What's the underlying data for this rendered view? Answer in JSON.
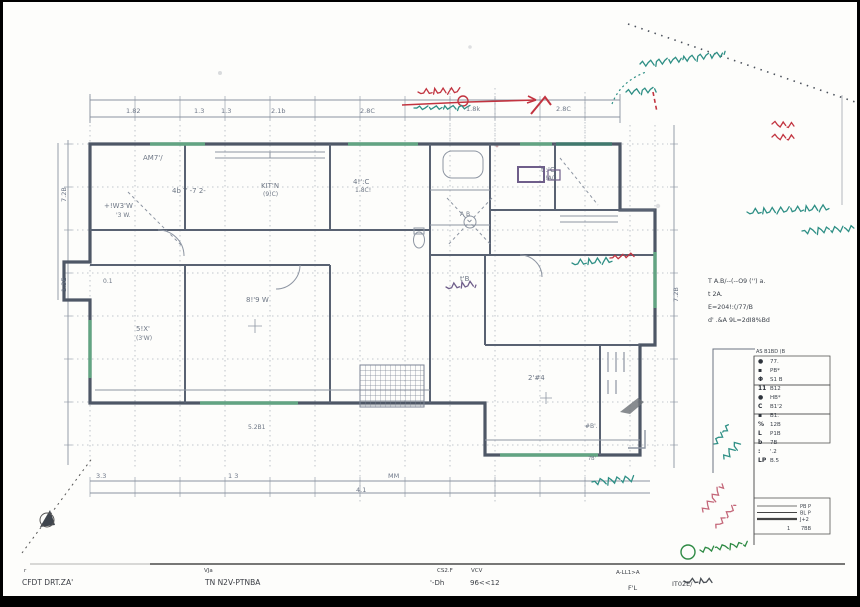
{
  "colors": {
    "plan_ink": "#5c6575",
    "wall": "#4e5766",
    "grid": "#adb4bd",
    "dim": "#8a93a0",
    "teal": "#2e8f85",
    "red": "#c23440",
    "green": "#2e8a44",
    "pink": "#c4687a",
    "purple": "#6f5e8a",
    "gray_note": "#4a4f55",
    "window_green": "#66b287",
    "window_teal": "#3f7d6e"
  },
  "dimensions": {
    "top": [
      {
        "t": "1.82",
        "x": 126,
        "y": 113
      },
      {
        "t": "1.3",
        "x": 194,
        "y": 113
      },
      {
        "t": "1.3",
        "x": 221,
        "y": 113
      },
      {
        "t": "2.1b",
        "x": 271,
        "y": 113
      },
      {
        "t": "2.8C",
        "x": 360,
        "y": 113
      },
      {
        "t": "1.8k",
        "x": 466,
        "y": 111
      },
      {
        "t": "2.8C",
        "x": 556,
        "y": 111
      }
    ],
    "bottom": [
      {
        "t": "3.3",
        "x": 96,
        "y": 478
      },
      {
        "t": "1 3",
        "x": 228,
        "y": 478
      },
      {
        "t": "MM",
        "x": 388,
        "y": 478
      },
      {
        "t": "4.1",
        "x": 356,
        "y": 492
      }
    ],
    "left": [
      {
        "t": "7.2B",
        "x": 66,
        "y": 202
      },
      {
        "t": "1.3E",
        "x": 66,
        "y": 292
      }
    ],
    "right": [
      {
        "t": "7.2B",
        "x": 678,
        "y": 302
      }
    ]
  },
  "room_labels": [
    {
      "t": "AM7'/",
      "x": 143,
      "y": 160,
      "s": 7
    },
    {
      "t": "4b Y -7 2-",
      "x": 172,
      "y": 193,
      "s": 7
    },
    {
      "t": "+!W3'W",
      "x": 104,
      "y": 208,
      "s": 7
    },
    {
      "t": "'3 W.",
      "x": 116,
      "y": 217,
      "s": 6
    },
    {
      "t": "KIT'N",
      "x": 261,
      "y": 188,
      "s": 7
    },
    {
      "t": "(9!C)",
      "x": 263,
      "y": 196,
      "s": 6
    },
    {
      "t": "4!':C",
      "x": 353,
      "y": 184,
      "s": 7
    },
    {
      "t": "1.8C!",
      "x": 355,
      "y": 192,
      "s": 6
    },
    {
      "t": "t':'C",
      "x": 541,
      "y": 172,
      "s": 7
    },
    {
      "t": "!!A()",
      "x": 543,
      "y": 180,
      "s": 6
    },
    {
      "t": "A B",
      "x": 460,
      "y": 216,
      "s": 6
    },
    {
      "t": "8!'9 W",
      "x": 246,
      "y": 302,
      "s": 7
    },
    {
      "t": "5!X'",
      "x": 136,
      "y": 331,
      "s": 7
    },
    {
      "t": "(3'W)",
      "x": 136,
      "y": 340,
      "s": 6
    },
    {
      "t": "t'B",
      "x": 460,
      "y": 281,
      "s": 7
    },
    {
      "t": "0.1",
      "x": 103,
      "y": 283,
      "s": 6
    },
    {
      "t": "2'#4",
      "x": 528,
      "y": 380,
      "s": 7
    },
    {
      "t": "5.2B1",
      "x": 248,
      "y": 429,
      "s": 6
    },
    {
      "t": "#B'.",
      "x": 585,
      "y": 428,
      "s": 6
    },
    {
      "t": "7B'",
      "x": 588,
      "y": 460,
      "s": 5
    }
  ],
  "legend": {
    "header": "AS B1BD (B",
    "rows": [
      {
        "sym": "●",
        "label": "77."
      },
      {
        "sym": "▪",
        "label": "PB*"
      },
      {
        "sym": "Φ",
        "label": "S1 B"
      },
      {
        "sym": "11",
        "label": "B12"
      },
      {
        "sym": "●",
        "label": "HB*"
      },
      {
        "sym": "C",
        "label": "B1'2"
      },
      {
        "sym": "▪",
        "label": "B1."
      },
      {
        "sym": "%",
        "label": "12B"
      },
      {
        "sym": "L",
        "label": "P1B"
      },
      {
        "sym": "b",
        "label": "7B"
      },
      {
        "sym": ":",
        "label": "'.2"
      },
      {
        "sym": "LP",
        "label": "B.5"
      }
    ],
    "line_rows": [
      {
        "label": "PB P",
        "weight": 0.8
      },
      {
        "label": "BL P",
        "weight": 1.1
      },
      {
        "label": "J+2",
        "weight": 2.2
      }
    ],
    "scale_left": "1",
    "scale_right": "7BB"
  },
  "notes": {
    "lines": [
      "T A.B/--(--O9 ('') a.",
      "t  2A.",
      "E=204!:(/77/B",
      "d' .&A 9L=2dI8%Bd"
    ]
  },
  "title_block": {
    "fields": [
      {
        "label": "r",
        "value": "CFDT DRT.ZA'"
      },
      {
        "label": "VJa",
        "value": "TN N2V-PTNBA"
      },
      {
        "label": "CS2.F",
        "value": "'-Dh"
      },
      {
        "label": "VCV",
        "value": "96<<12"
      },
      {
        "label": "A-LL1>A",
        "value": "F'L"
      },
      {
        "label": "",
        "value": "IT02E/"
      }
    ]
  },
  "annotations": {
    "scribbles": [
      {
        "id": "teal-boundary-note-1",
        "color": "teal",
        "x": 640,
        "y": 64,
        "w": 86,
        "amp": 2.6,
        "rot": -7
      },
      {
        "id": "teal-boundary-note-2",
        "color": "teal",
        "x": 626,
        "y": 92,
        "w": 30,
        "amp": 2.4,
        "rot": -5
      },
      {
        "id": "teal-under-redline",
        "color": "teal",
        "x": 414,
        "y": 108,
        "w": 56,
        "amp": 2.8,
        "rot": -1
      },
      {
        "id": "teal-note-right-1",
        "color": "teal",
        "x": 747,
        "y": 212,
        "w": 82,
        "amp": 2.6,
        "rot": -3
      },
      {
        "id": "teal-note-right-2",
        "color": "teal",
        "x": 802,
        "y": 231,
        "w": 52,
        "amp": 2.4,
        "rot": -3
      },
      {
        "id": "teal-note-plan",
        "color": "teal",
        "x": 572,
        "y": 263,
        "w": 40,
        "amp": 2.6,
        "rot": -4
      },
      {
        "id": "teal-note-legend-1",
        "color": "teal",
        "x": 714,
        "y": 444,
        "w": 24,
        "amp": 3,
        "rot": -52
      },
      {
        "id": "teal-note-legend-2",
        "color": "teal",
        "x": 724,
        "y": 459,
        "w": 22,
        "amp": 3,
        "rot": -50
      },
      {
        "id": "teal-note-bottom",
        "color": "teal",
        "x": 592,
        "y": 482,
        "w": 42,
        "amp": 2.6,
        "rot": -5
      },
      {
        "id": "red-note-topline",
        "color": "red",
        "x": 418,
        "y": 92,
        "w": 42,
        "amp": 2.4,
        "rot": -2
      },
      {
        "id": "red-mark-room",
        "color": "red",
        "x": 610,
        "y": 258,
        "w": 24,
        "amp": 3,
        "rot": -8
      },
      {
        "id": "red-seal-1",
        "color": "red",
        "x": 772,
        "y": 124,
        "w": 22,
        "amp": 3.4,
        "rot": 4
      },
      {
        "id": "red-seal-2",
        "color": "red",
        "x": 772,
        "y": 137,
        "w": 22,
        "amp": 3.4,
        "rot": 2
      },
      {
        "id": "pink-note-1",
        "color": "pink",
        "x": 703,
        "y": 512,
        "w": 34,
        "amp": 3,
        "rot": -55
      },
      {
        "id": "pink-note-2",
        "color": "pink",
        "x": 716,
        "y": 528,
        "w": 30,
        "amp": 3,
        "rot": -50
      },
      {
        "id": "green-note-titleblock",
        "color": "green",
        "x": 700,
        "y": 550,
        "w": 48,
        "amp": 3,
        "rot": -8
      },
      {
        "id": "gray-note-titleblock",
        "color": "gray",
        "x": 684,
        "y": 581,
        "w": 28,
        "amp": 2,
        "rot": 0
      },
      {
        "id": "purple-mark-plan",
        "color": "purple",
        "x": 446,
        "y": 287,
        "w": 30,
        "amp": 2.6,
        "rot": -6
      }
    ]
  }
}
